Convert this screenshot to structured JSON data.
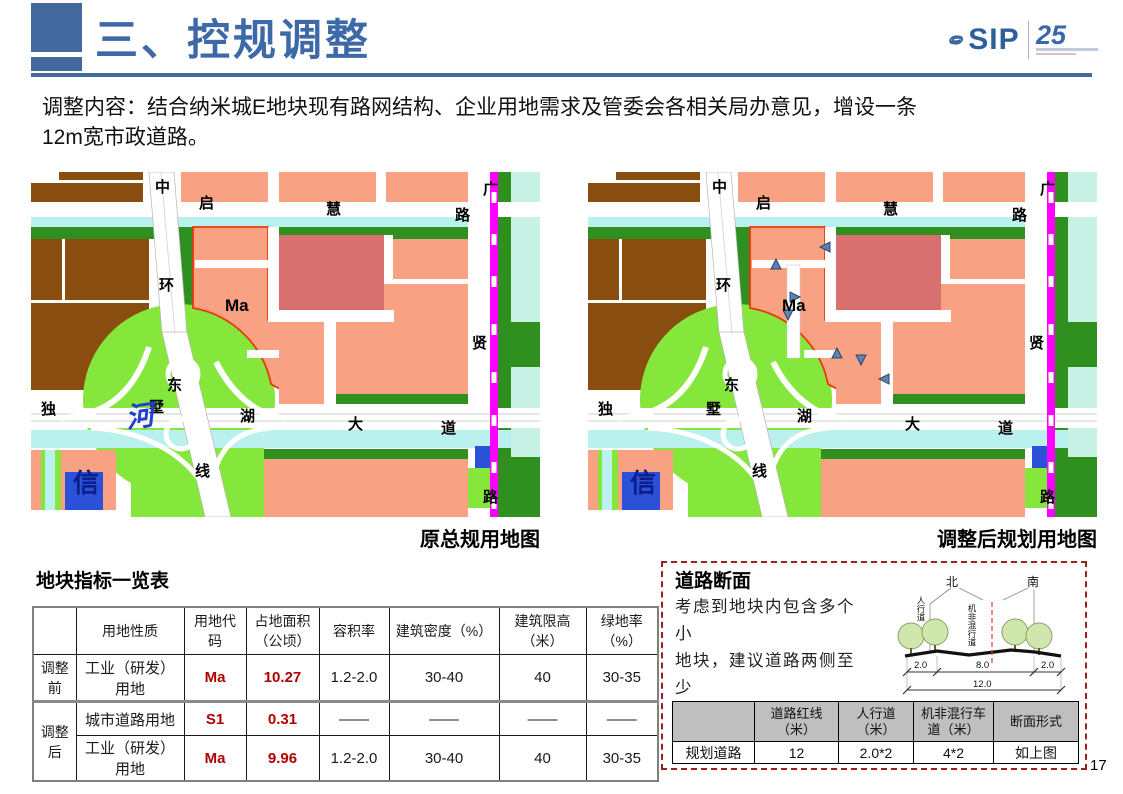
{
  "header": {
    "title": "三、控规调整",
    "logo": {
      "text": "SIP",
      "anniversary": "25"
    }
  },
  "intro": {
    "line1": "调整内容：结合纳米城E地块现有路网结构、企业用地需求及管委会各相关局办意见，增设一条",
    "line2": "12m宽市政道路。"
  },
  "colors": {
    "accent_blue": "#44699f",
    "title_blue": "#3d69a9",
    "salmon": "#f9a183",
    "brown": "#8a4d10",
    "dark_green": "#2f9020",
    "light_green": "#85e63c",
    "water_cyan": "#baf0ee",
    "pale_cyan": "#c9f2e6",
    "rose": "#d97070",
    "metro_magenta": "#ff00ff",
    "parcel_blue": "#2b51d8",
    "plot_outline_red": "#e8380d",
    "table_red": "#b00000",
    "box_border_red": "#9c2020",
    "header_gray": "#bfbfbf"
  },
  "maps": {
    "left": {
      "caption": "原总规用地图",
      "labels": [
        {
          "t": "中",
          "x": 124,
          "y": 8
        },
        {
          "t": "启",
          "x": 168,
          "y": 24
        },
        {
          "t": "慧",
          "x": 295,
          "y": 30
        },
        {
          "t": "路",
          "x": 424,
          "y": 36
        },
        {
          "t": "广",
          "x": 452,
          "y": 10
        },
        {
          "t": "环",
          "x": 128,
          "y": 106
        },
        {
          "t": "Ma",
          "x": 194,
          "y": 126,
          "cls": "ma"
        },
        {
          "t": "贤",
          "x": 441,
          "y": 164
        },
        {
          "t": "独",
          "x": 10,
          "y": 230
        },
        {
          "t": "东",
          "x": 136,
          "y": 206
        },
        {
          "t": "墅",
          "x": 118,
          "y": 228
        },
        {
          "t": "河",
          "x": 95,
          "y": 238,
          "cls": "river"
        },
        {
          "t": "湖",
          "x": 209,
          "y": 237
        },
        {
          "t": "大",
          "x": 317,
          "y": 245
        },
        {
          "t": "道",
          "x": 410,
          "y": 249
        },
        {
          "t": "线",
          "x": 164,
          "y": 292
        },
        {
          "t": "路",
          "x": 452,
          "y": 318
        },
        {
          "t": "信",
          "x": 42,
          "y": 303,
          "cls": "xin"
        }
      ]
    },
    "right": {
      "caption": "调整后规划用地图",
      "labels": [
        {
          "t": "中",
          "x": 124,
          "y": 8
        },
        {
          "t": "启",
          "x": 168,
          "y": 24
        },
        {
          "t": "慧",
          "x": 295,
          "y": 30
        },
        {
          "t": "路",
          "x": 424,
          "y": 36
        },
        {
          "t": "广",
          "x": 452,
          "y": 10
        },
        {
          "t": "环",
          "x": 128,
          "y": 106
        },
        {
          "t": "Ma",
          "x": 194,
          "y": 126,
          "cls": "ma"
        },
        {
          "t": "贤",
          "x": 441,
          "y": 164
        },
        {
          "t": "独",
          "x": 10,
          "y": 230
        },
        {
          "t": "东",
          "x": 136,
          "y": 206
        },
        {
          "t": "墅",
          "x": 118,
          "y": 230
        },
        {
          "t": "湖",
          "x": 209,
          "y": 237
        },
        {
          "t": "大",
          "x": 317,
          "y": 245
        },
        {
          "t": "道",
          "x": 410,
          "y": 249
        },
        {
          "t": "线",
          "x": 164,
          "y": 292
        },
        {
          "t": "路",
          "x": 452,
          "y": 318
        },
        {
          "t": "信",
          "x": 42,
          "y": 303,
          "cls": "xin"
        }
      ]
    }
  },
  "indicator_table": {
    "title": "地块指标一览表",
    "headers": [
      "",
      "用地性质",
      "用地代码",
      "占地面积（公顷）",
      "容积率",
      "建筑密度（%）",
      "建筑限高（米）",
      "绿地率（%）"
    ],
    "rows": [
      {
        "stage": "调整前",
        "use": "工业（研发）用地",
        "code": "Ma",
        "area": "10.27",
        "far": "1.2-2.0",
        "density": "30-40",
        "height": "40",
        "green": "30-35"
      },
      {
        "stage": "调整后",
        "use": "城市道路用地",
        "code": "S1",
        "area": "0.31",
        "far": "——",
        "density": "——",
        "height": "——",
        "green": "——"
      },
      {
        "stage": "",
        "use": "工业（研发）用地",
        "code": "Ma",
        "area": "9.96",
        "far": "1.2-2.0",
        "density": "30-40",
        "height": "40",
        "green": "30-35"
      }
    ]
  },
  "road_section": {
    "title": "道路断面",
    "note_line1": "考虑到地块内包含多个小",
    "note_line2": "地块，建议道路两侧至少",
    "note_line3": "各留2m的人行道",
    "diagram": {
      "north": "北",
      "south": "南",
      "sidewalk_label": "人行道",
      "lane_label": "机非混行道",
      "dim_left": "2.0",
      "dim_center": "8.0",
      "dim_right": "2.0",
      "dim_total": "12.0"
    },
    "table": {
      "headers": [
        "",
        "道路红线（米）",
        "人行道（米）",
        "机非混行车道（米）",
        "断面形式"
      ],
      "row": {
        "name": "规划道路",
        "redline": "12",
        "sidewalk": "2.0*2",
        "lane": "4*2",
        "form": "如上图"
      }
    }
  },
  "page_number": "17"
}
